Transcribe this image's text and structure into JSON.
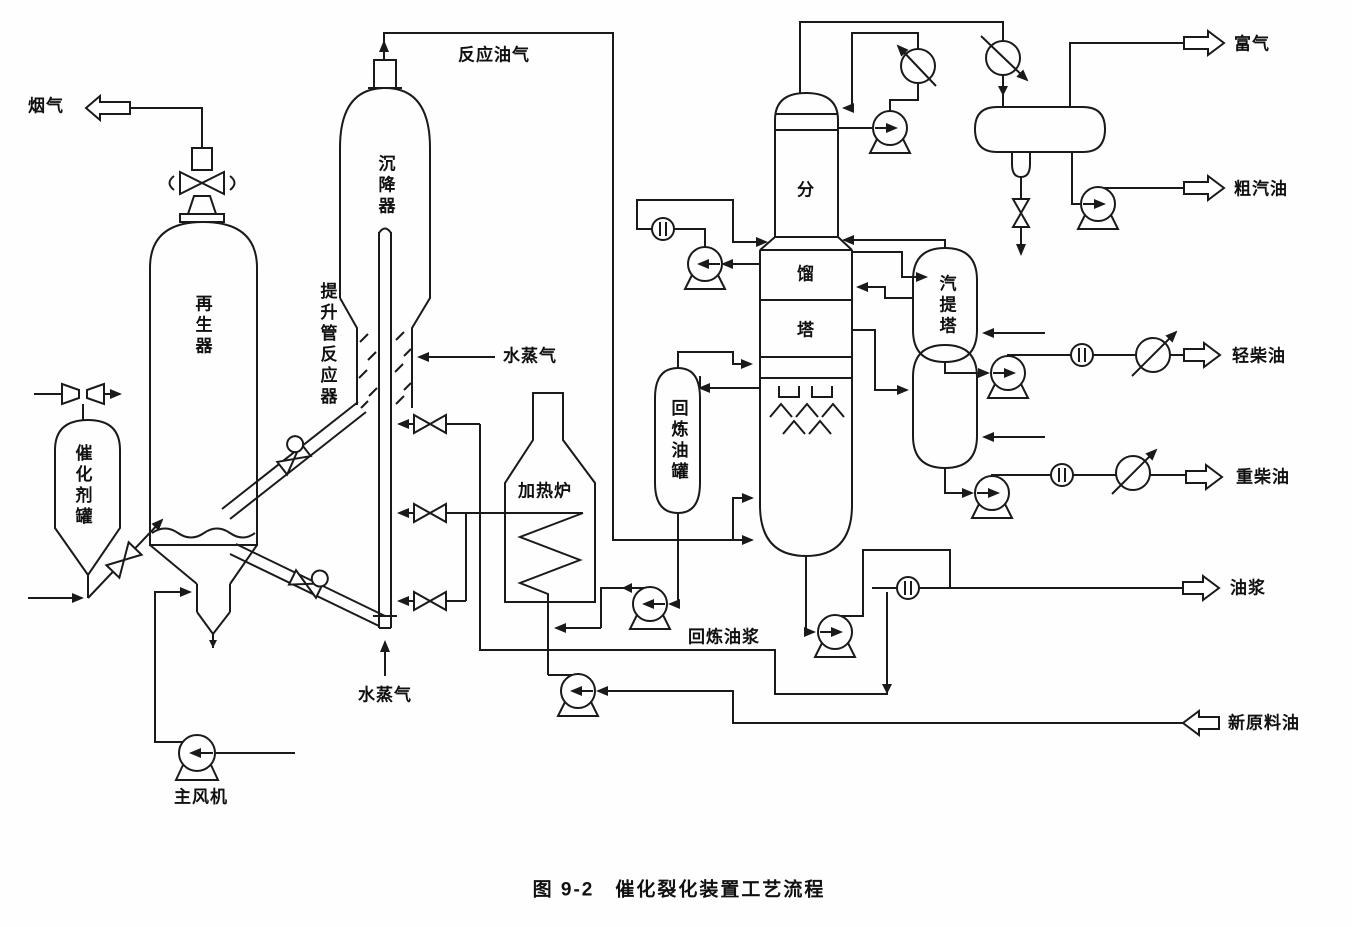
{
  "figure": {
    "caption": "图 9-2　催化裂化装置工艺流程"
  },
  "colors": {
    "line": "#1a1a1a",
    "background": "#fefefe"
  },
  "equipment": {
    "regenerator": "再生器",
    "settler": "沉降器",
    "riser_reactor": "提升管反应器",
    "catalyst_tank": "催化剂罐",
    "main_blower": "主风机",
    "heating_furnace": "加热炉",
    "recycle_oil_tank": "回炼油罐",
    "fractionator": [
      "分",
      "馏",
      "塔"
    ],
    "stripper": "汽提塔"
  },
  "streams": {
    "flue_gas": "烟气",
    "reaction_oil_gas": "反应油气",
    "steam_upper": "水蒸气",
    "steam_lower": "水蒸气",
    "recycle_slurry": "回炼油浆",
    "rich_gas": "富气",
    "crude_gasoline": "粗汽油",
    "light_diesel": "轻柴油",
    "heavy_diesel": "重柴油",
    "oil_slurry": "油浆",
    "fresh_feed": "新原料油"
  }
}
